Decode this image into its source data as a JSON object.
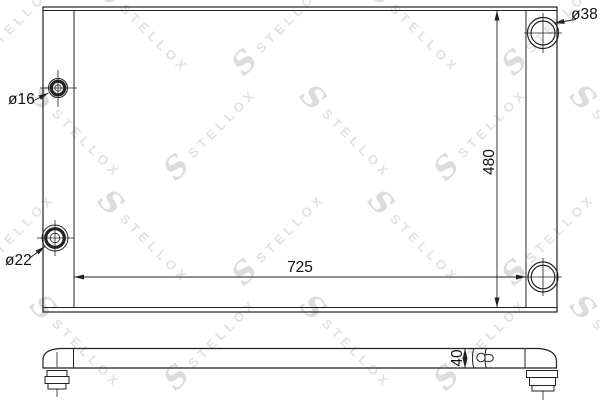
{
  "drawing": {
    "kind": "radiator-technical-drawing",
    "labels": {
      "fitting_top_left_dia": "ø16",
      "fitting_bottom_left_dia": "ø22",
      "fitting_top_right_dia": "ø38",
      "core_width": "725",
      "core_height": "480",
      "thickness": "40"
    },
    "line_color": "#222222",
    "background": "#ffffff"
  },
  "watermark": {
    "logo": "S",
    "text": "STELLOX",
    "color": "#e2e2e2"
  }
}
